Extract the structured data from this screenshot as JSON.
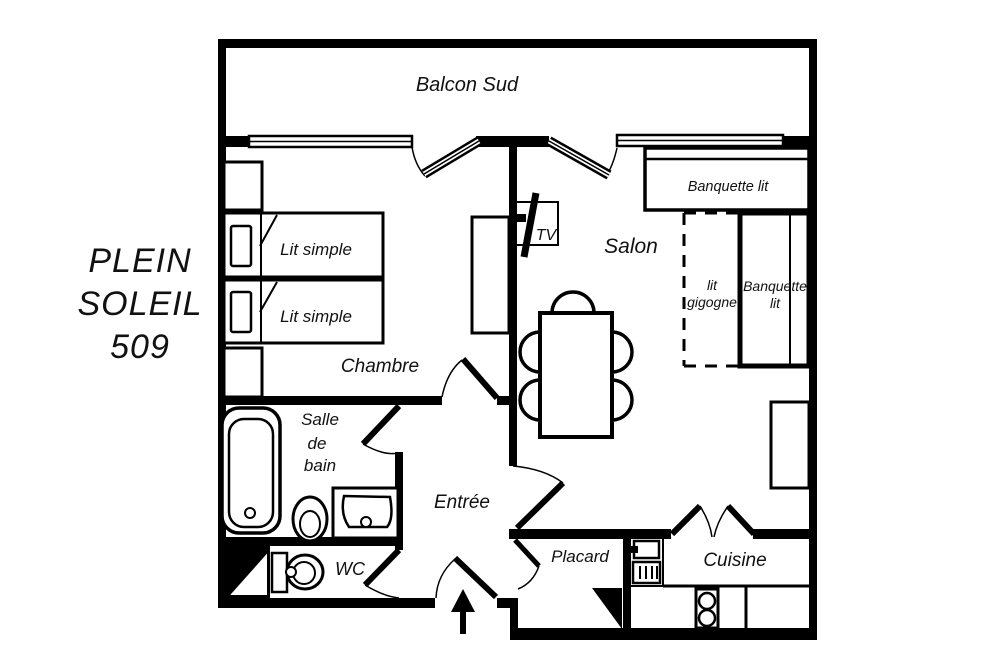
{
  "title": {
    "line1": "PLEIN",
    "line2": "SOLEIL",
    "line3": "509"
  },
  "rooms": {
    "balcony": "Balcon Sud",
    "bedroom": "Chambre",
    "living": "Salon",
    "bathroom_line1": "Salle",
    "bathroom_line2": "de",
    "bathroom_line3": "bain",
    "entry": "Entrée",
    "wc": "WC",
    "closet": "Placard",
    "kitchen": "Cuisine"
  },
  "furniture": {
    "single_bed": "Lit simple",
    "bench_bed": "Banquette lit",
    "bench_bed_line1": "Banquette",
    "bench_bed_line2": "lit",
    "trundle_line1": "lit",
    "trundle_line2": "gigogne",
    "tv": "TV"
  },
  "colors": {
    "wall": "#000000",
    "background": "#ffffff",
    "text": "#111111"
  }
}
